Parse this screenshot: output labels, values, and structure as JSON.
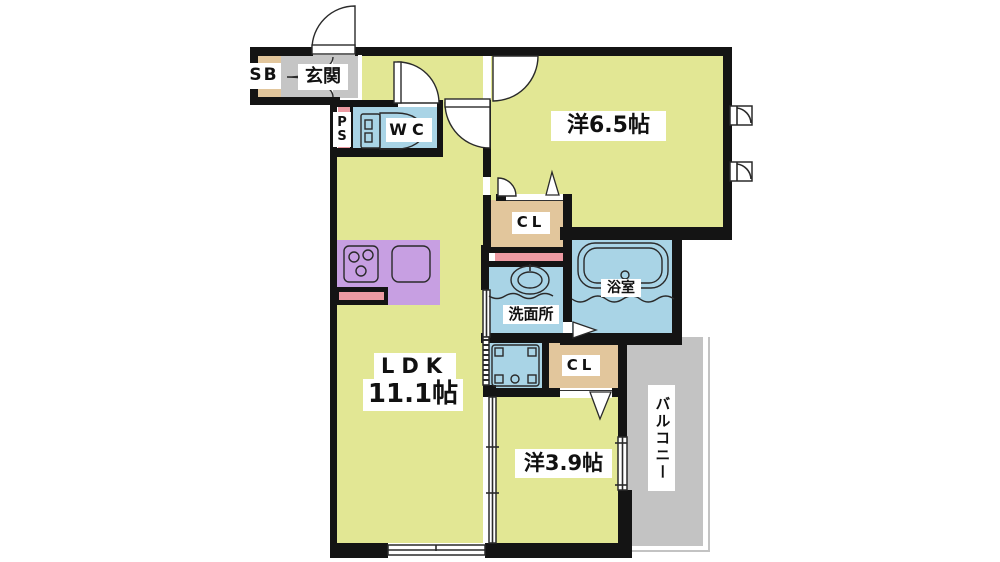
{
  "title": "1LDK apartment floor plan",
  "palette": {
    "wall": "#141414",
    "line": "#2a2a2a",
    "white": "#ffffff",
    "room_yellow": "#e2e794",
    "water_blue": "#a9d4e6",
    "closet_tan": "#e2c69c",
    "kitchen_purple": "#c79fe2",
    "pink": "#ed9aa2",
    "entrance_gray": "#c5c5c5",
    "balcony_gray": "#c3c3c3"
  },
  "rooms": {
    "entrance": {
      "label": "玄関"
    },
    "shoe_box": {
      "label": "SB"
    },
    "pipe_space": {
      "letters": [
        "P",
        "S"
      ]
    },
    "toilet": {
      "label": "WC"
    },
    "western_room_65": {
      "label": "洋6.5帖"
    },
    "closet_1": {
      "label": "CL"
    },
    "closet_2": {
      "label": "CL"
    },
    "bathroom": {
      "label": "浴室"
    },
    "washroom": {
      "label": "洗面所"
    },
    "ldk": {
      "label": "LDK",
      "size": "11.1帖"
    },
    "western_room_39": {
      "label": "洋3.9帖"
    },
    "balcony": {
      "label": "バルコニー"
    }
  },
  "icons": {
    "fixtures": [
      "entrance-door-arc",
      "shoe-box-doors",
      "toilet-icon",
      "stove-icon",
      "kitchen-sink-icon",
      "bathtub-icon",
      "washbasin-icon",
      "washing-machine-pan-icon",
      "awning-window-icon",
      "sliding-window-icon",
      "sliding-door-icon",
      "door-swing-arc",
      "door-triangle"
    ]
  }
}
